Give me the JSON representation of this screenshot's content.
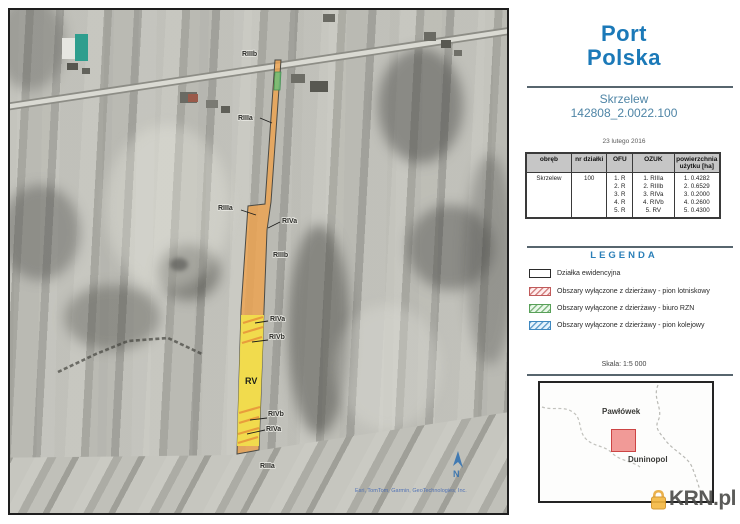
{
  "header": {
    "logo_line1": "Port",
    "logo_line2": "Polska",
    "title": "Skrzelew",
    "parcel_id": "142808_2.0022.100",
    "date": "23 lutego 2016"
  },
  "table": {
    "headers": [
      "obręb",
      "nr działki",
      "OFU",
      "OZUK",
      "powierzchnia użytku [ha]"
    ],
    "row": {
      "obreb": "Skrzelew",
      "nr_dzialki": "100",
      "ofu": [
        "1. R",
        "2. R",
        "3. R",
        "4. R",
        "5. R"
      ],
      "ozuk": [
        "1. RIIIa",
        "2. RIIIb",
        "3. RIVa",
        "4. RIVb",
        "5. RV"
      ],
      "powierzchnia": [
        "1. 0.4282",
        "2. 0.6529",
        "3. 0.2000",
        "4. 0.2600",
        "5. 0.4300"
      ]
    }
  },
  "legend": {
    "title": "LEGENDA",
    "items": [
      {
        "label": "Działka ewidencyjna",
        "type": "parcel"
      },
      {
        "label": "Obszary wyłączone z dzierżawy - pion lotniskowy",
        "type": "red-hatch"
      },
      {
        "label": "Obszary wyłączone z dzierżawy - biuro RZN",
        "type": "green-hatch"
      },
      {
        "label": "Obszary wyłączone z dzierżawy - pion kolejowy",
        "type": "blue-hatch"
      }
    ]
  },
  "scale": "Skala: 1:5 000",
  "minimap": {
    "label_top": "Pawłówek",
    "label_bottom": "Duninopol"
  },
  "watermark": "KRN.pl",
  "map": {
    "north_label": "N",
    "attribution": "Esri, TomTom, Garmin, GeoTechnologies, Inc.",
    "labels": [
      {
        "text": "RIIIb"
      },
      {
        "text": "RIIIa"
      },
      {
        "text": "RIIIa"
      },
      {
        "text": "RIVa"
      },
      {
        "text": "RIIIb"
      },
      {
        "text": "RIVa"
      },
      {
        "text": "RIVb"
      },
      {
        "text": "RV"
      },
      {
        "text": "RIVb"
      },
      {
        "text": "RIVa"
      },
      {
        "text": "RIIIa"
      }
    ]
  },
  "colors": {
    "brand_blue": "#1b79b8",
    "subtitle_blue": "#4f85a6",
    "legend_blue": "#2a7fb8",
    "parcel_orange": "#f0a24a",
    "parcel_yellow": "#f2df4e",
    "minimap_red": "#f19a97",
    "krn_orange": "#f5a623"
  }
}
